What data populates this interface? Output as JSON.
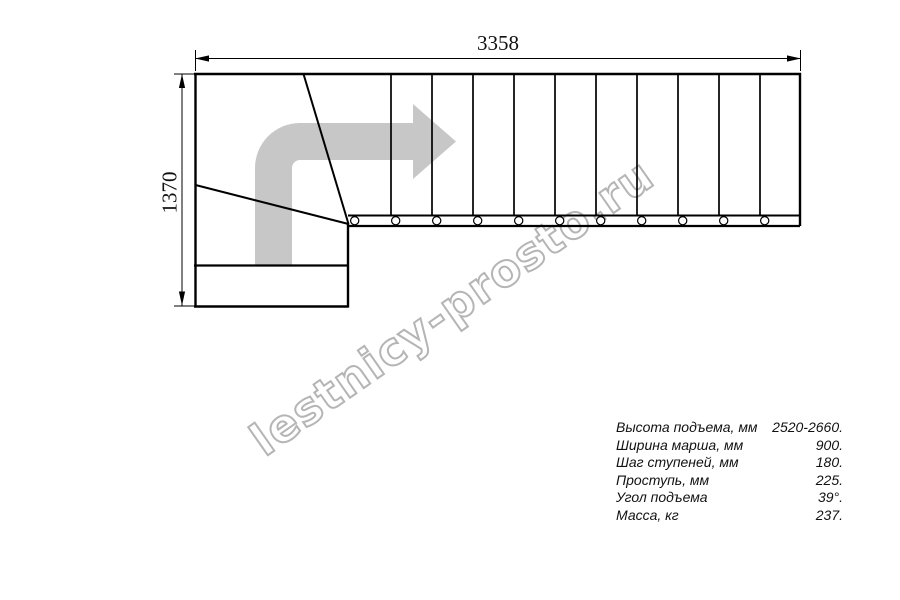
{
  "drawing": {
    "type": "staircase-plan-top-view",
    "dimension_width_mm": "3358",
    "dimension_height_mm": "1370",
    "straight_treads_count": 11,
    "winder_treads_count": 3,
    "baluster_count": 11,
    "direction_arrow": "turn-right-then-straight",
    "arrow_color": "#c7c7c7",
    "line_color": "#000000"
  },
  "watermark": {
    "text": "lestnicy-prosto.ru",
    "color": "#b5b5b5"
  },
  "specs": {
    "rows": [
      {
        "label": "Высота подъема, мм",
        "value": "2520-2660."
      },
      {
        "label": "Ширина марша, мм",
        "value": "900."
      },
      {
        "label": "Шаг ступеней, мм",
        "value": "180."
      },
      {
        "label": "Проступь, мм",
        "value": "225."
      },
      {
        "label": "Угол подъема",
        "value": "39°."
      },
      {
        "label": "Масса, кг",
        "value": "237."
      }
    ]
  }
}
